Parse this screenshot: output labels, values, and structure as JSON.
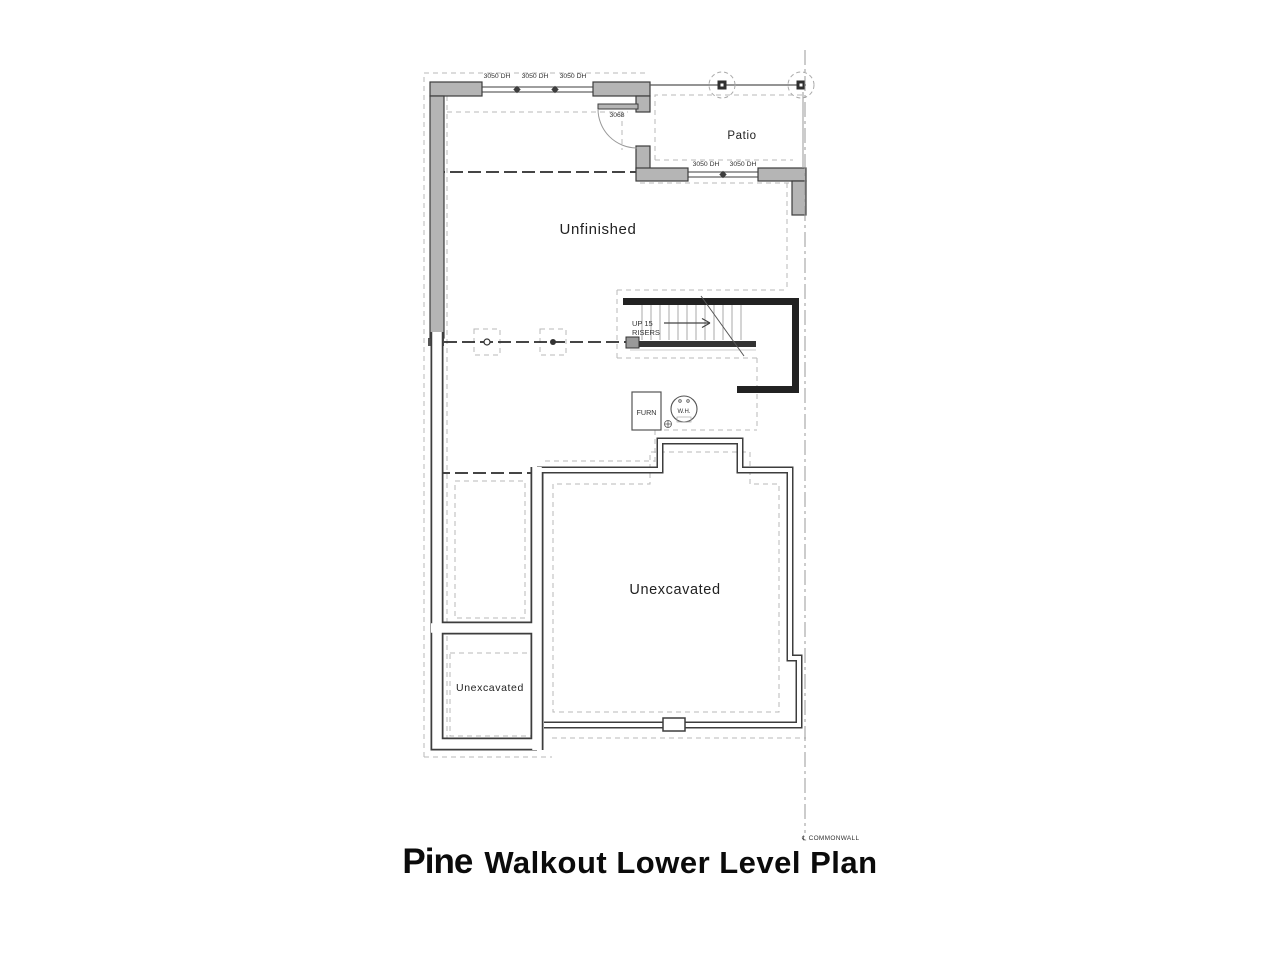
{
  "plan": {
    "title": {
      "logo": "Pine",
      "rest": "Walkout Lower Level Plan"
    },
    "rooms": {
      "unfinished": "Unfinished",
      "patio": "Patio",
      "unexcavated_main": "Unexcavated",
      "unexcavated_small": "Unexcavated"
    },
    "windows": {
      "labels": [
        "3050 DH",
        "3050 DH",
        "3050 DH",
        "3050 DH",
        "3050 DH"
      ]
    },
    "door": {
      "label": "3068"
    },
    "stairs": {
      "line1": "UP 15",
      "line2": "RISERS"
    },
    "equipment": {
      "furnace": "FURN",
      "water_heater": "W.H."
    },
    "commonwall_label": "℄ COMMONWALL",
    "colors": {
      "wall_fill": "#b5b5b5",
      "wall_stroke": "#3d3d3d",
      "stair_wall": "#222222",
      "dash_light": "#b8b8b8",
      "dash_heavy": "#2b2b2b",
      "centerline": "#999999",
      "text": "#222222"
    }
  }
}
